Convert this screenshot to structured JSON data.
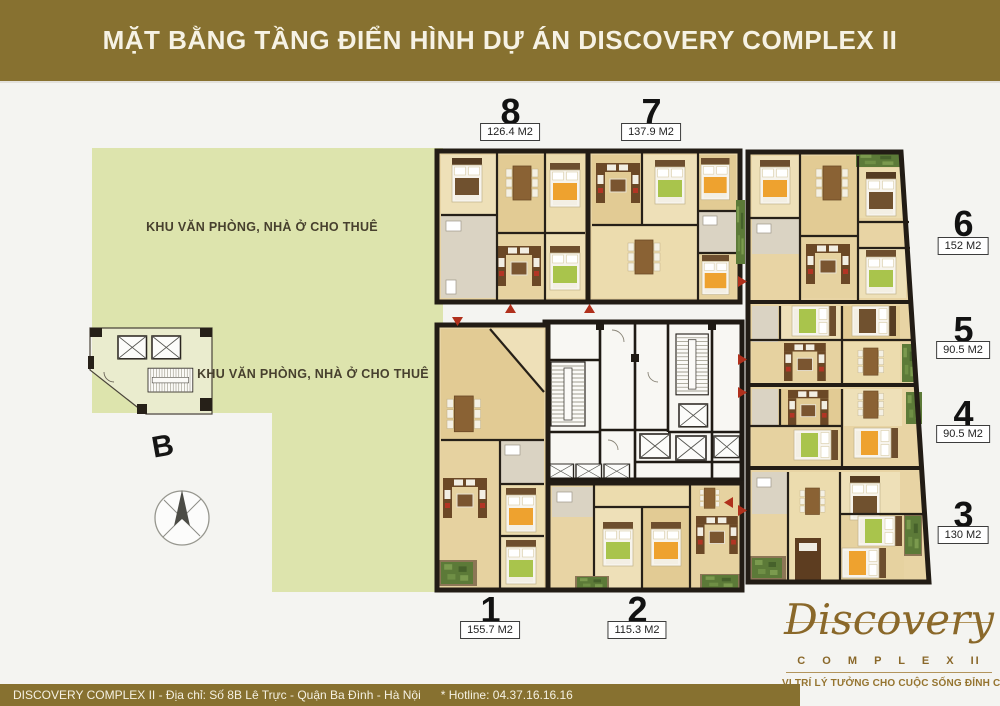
{
  "header": {
    "title": "MẶT BẰNG TẦNG ĐIỂN HÌNH DỰ ÁN DISCOVERY COMPLEX II"
  },
  "plan": {
    "zone_labels": [
      "KHU VĂN PHÒNG, NHÀ Ở CHO THUÊ",
      "KHU VĂN PHÒNG, NHÀ Ở CHO THUÊ"
    ],
    "compass_north_label": "B",
    "units": [
      {
        "number": "8",
        "area": "126.4 M2"
      },
      {
        "number": "7",
        "area": "137.9 M2"
      },
      {
        "number": "6",
        "area": "152 M2"
      },
      {
        "number": "5",
        "area": "90.5 M2"
      },
      {
        "number": "4",
        "area": "90.5 M2"
      },
      {
        "number": "3",
        "area": "130 M2"
      },
      {
        "number": "1",
        "area": "155.7 M2"
      },
      {
        "number": "2",
        "area": "115.3 M2"
      }
    ]
  },
  "footer": {
    "address": "DISCOVERY COMPLEX II - Địa chỉ: Số 8B Lê Trực - Quận Ba Đình - Hà Nội",
    "hotline": "* Hotline: 04.37.16.16.16"
  },
  "logo": {
    "name": "Discovery",
    "complex_label": "C O M P L E X",
    "numeral": "II",
    "tagline": "VỊ TRÍ LÝ TƯỞNG CHO CUỘC SỐNG ĐỈNH CAO"
  },
  "colors": {
    "brand_gold": "#877130",
    "zone_green": "#dde4ad",
    "wood_floor": "#e8d4a4",
    "marker_red": "#b0301c"
  }
}
